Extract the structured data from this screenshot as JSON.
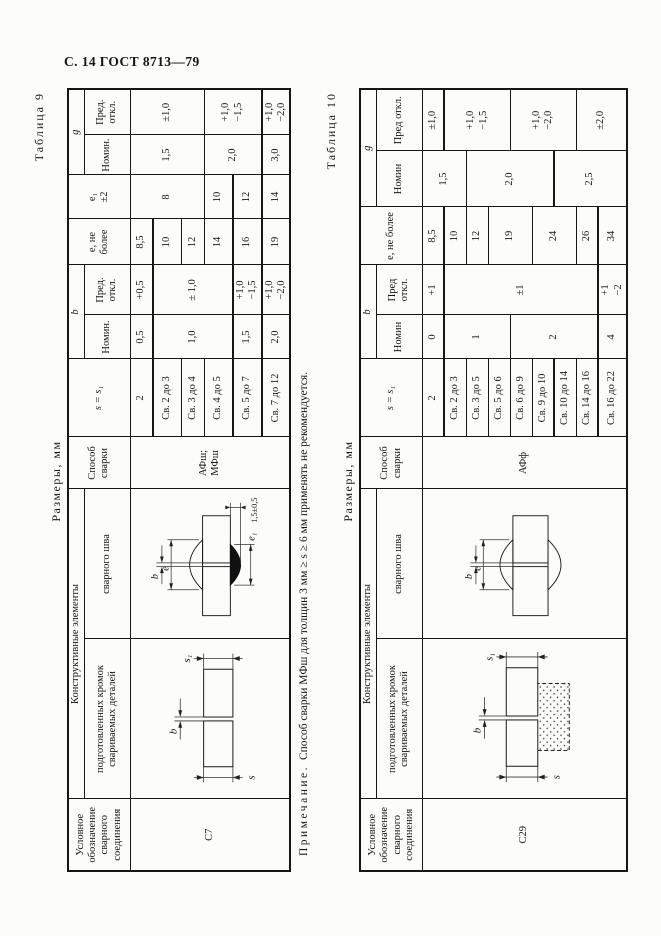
{
  "page": {
    "header": "С. 14 ГОСТ 8713—79"
  },
  "note": {
    "label": "Примечание.",
    "text": "Способ сварки МФш для толщин 3 мм ≥ s ≥ 6 мм применять не рекомендуется."
  },
  "dg": {
    "b": "b",
    "e": "e",
    "e1": "e₁",
    "s": "s",
    "s1": "s₁",
    "bead_height": "1,5±0,5"
  },
  "t9": {
    "label": "Таблица 9",
    "sizes": "Размеры, мм",
    "h": {
      "designation": "Условное обозначение сварного соединения",
      "constructive": "Конструктивные элементы",
      "edges": "подготовленных кромок свариваемых деталей",
      "weld": "сварного шва",
      "method": "Способ сварки",
      "s": "s = s₁",
      "b": "b",
      "nom": "Номин.",
      "dev": "Пред. откл.",
      "e": "е, не более",
      "e1": "е₁\n±2",
      "g": "g"
    },
    "designation": "С7",
    "method": "АФш;\nМФш",
    "rows": [
      {
        "s": "2",
        "bn": "0,5",
        "bd": "+0,5",
        "e": "8,5",
        "e1": "8",
        "gn": "1,5",
        "gd": "±1,0"
      },
      {
        "s": "Св. 2 до 3",
        "bn": "1,0",
        "bd": "± 1,0",
        "e": "10"
      },
      {
        "s": "Св. 3 до 4",
        "e": "12"
      },
      {
        "s": "Св. 4 до 5",
        "e": "14",
        "e1": "10",
        "gn": "2,0",
        "gd": "+1,0\n−1,5"
      },
      {
        "s": "Св. 5 до 7",
        "bn": "1,5",
        "bd": "+1,0\n−1,5",
        "e": "16",
        "e1": "12"
      },
      {
        "s": "Св. 7 до 12",
        "bn": "2,0",
        "bd": "+1,0\n−2,0",
        "e": "19",
        "e1": "14",
        "gn": "3,0",
        "gd": "+1,0\n−2,0"
      }
    ]
  },
  "t10": {
    "label": "Таблица 10",
    "sizes": "Размеры, мм",
    "h": {
      "designation": "Условное обозначение сварного соединения",
      "constructive": "Конструктивные элементы",
      "edges": "подготовленных кромок свариваемых деталей",
      "weld": "сварного шва",
      "method": "Способ сварки",
      "s": "s = s₁",
      "b": "b",
      "nom": "Номин",
      "dev": "Пред откл.",
      "e": "е, не более",
      "g": "g"
    },
    "designation": "С29",
    "method": "АФф",
    "rows": [
      {
        "s": "2",
        "bn": "0",
        "bd": "+1",
        "e": "8,5",
        "gn": "1,5",
        "gd": "±1,0"
      },
      {
        "s": "Св. 2 до 3",
        "bn": "1",
        "bd": "±1",
        "e": "10",
        "gd": "+1,0\n−1,5"
      },
      {
        "s": "Св. 3 до 5",
        "e": "12",
        "gn": "2,0"
      },
      {
        "s": "Св. 5 до 6",
        "e": "19"
      },
      {
        "s": "Св. 6 до 9",
        "bn": "2",
        "gd": "+1,0\n−2,0"
      },
      {
        "s": "Св. 9 до 10",
        "e": "24"
      },
      {
        "s": "Св. 10 до 14",
        "gn": "2,5"
      },
      {
        "s": "Св. 14 до 16",
        "e": "26",
        "gd": "±2,0"
      },
      {
        "s": "Св. 16 до 22",
        "bn": "4",
        "bd": "+1\n−2",
        "e": "34"
      }
    ]
  }
}
